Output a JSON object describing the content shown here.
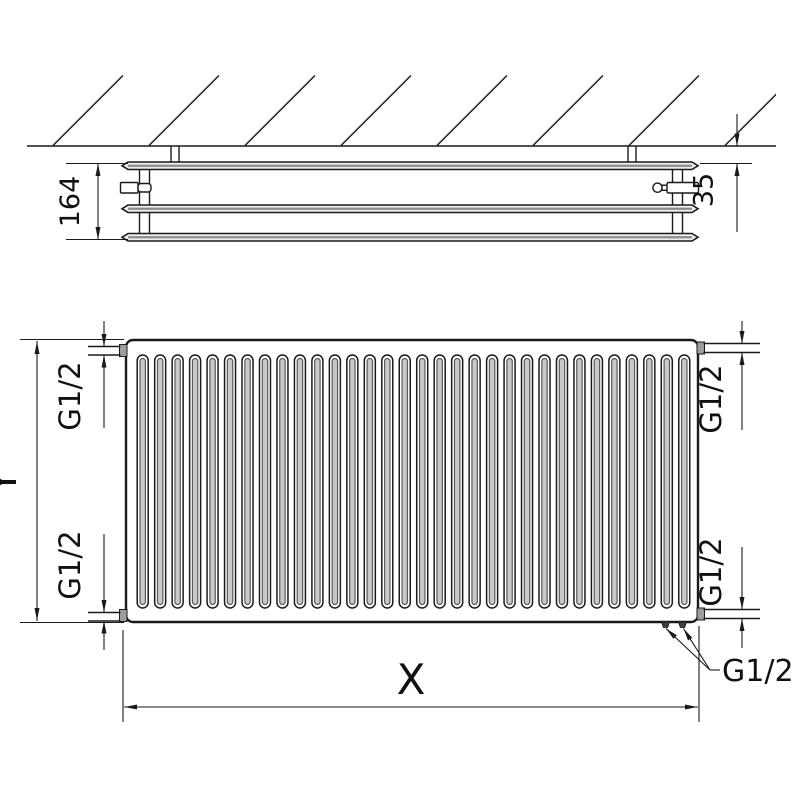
{
  "side_view": {
    "depth_dimension": "164",
    "wall_distance_dimension": "35",
    "panel_count": 3
  },
  "front_view": {
    "width_dimension": "X",
    "height_dimension": "Y",
    "fin_count": 32,
    "connection_labels": {
      "top_left": "G1/2",
      "top_right": "G1/2",
      "bottom_left": "G1/2",
      "bottom_right": "G1/2",
      "bottom_callout": "G1/2"
    }
  },
  "colors": {
    "line": "#1a1a1a",
    "panel_fill": "#ededed",
    "groove_fill": "#c9c9c9",
    "background": "#ffffff"
  }
}
